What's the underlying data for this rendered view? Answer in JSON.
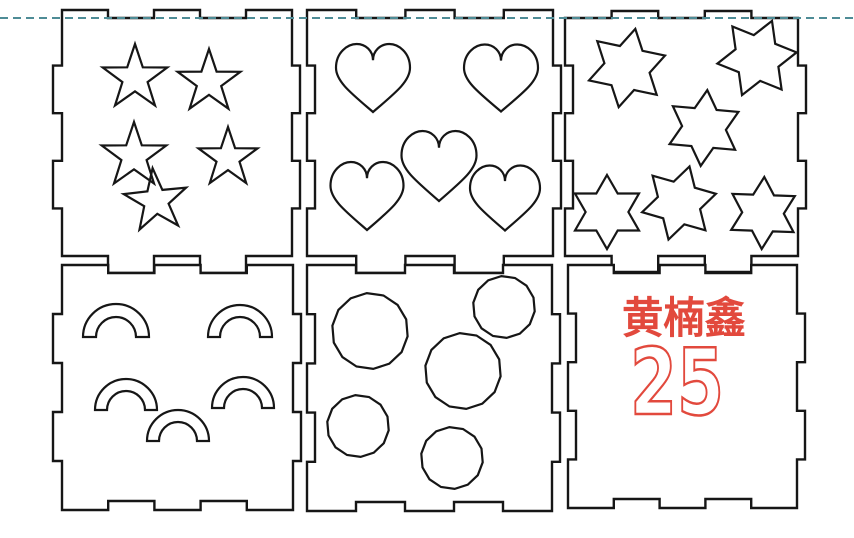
{
  "canvas": {
    "width": 854,
    "height": 538,
    "background": "#ffffff",
    "stroke_color": "#161616"
  },
  "guide_line": {
    "y": 18,
    "color": "#4e8c96",
    "dash": [
      8,
      5
    ],
    "thickness": 2
  },
  "engraving": {
    "color": "#e2493d"
  },
  "panels": [
    {
      "id": "plate-stars-5pt",
      "rect": {
        "x": 62,
        "y": 18,
        "w": 230,
        "h": 238
      },
      "edges": {
        "top": {
          "feature": "tabs_out",
          "segments": [
            1,
            3,
            5
          ],
          "depth": 8
        },
        "right": {
          "feature": "tabs_out",
          "segments": [
            2,
            4
          ],
          "depth": 8
        },
        "bottom": {
          "feature": "tabs_out",
          "segments": [
            2,
            4
          ],
          "depth": 17
        },
        "left": {
          "feature": "tabs_out",
          "segments": [
            2,
            4
          ],
          "depth": 9
        }
      },
      "shapes": {
        "type": "star5",
        "inner_ratio": 0.39,
        "items": [
          {
            "cx": 135,
            "cy": 78,
            "r": 34,
            "rot": 0
          },
          {
            "cx": 209,
            "cy": 82,
            "r": 33,
            "rot": 0
          },
          {
            "cx": 134,
            "cy": 156,
            "r": 34,
            "rot": 0
          },
          {
            "cx": 228,
            "cy": 158,
            "r": 31,
            "rot": 0
          },
          {
            "cx": 156,
            "cy": 201,
            "r": 33,
            "rot": -6
          }
        ]
      }
    },
    {
      "id": "plate-hearts",
      "rect": {
        "x": 307,
        "y": 18,
        "w": 246,
        "h": 238
      },
      "edges": {
        "top": {
          "feature": "tabs_out",
          "segments": [
            1,
            3,
            5
          ],
          "depth": 8
        },
        "right": {
          "feature": "tabs_out",
          "segments": [
            2,
            4
          ],
          "depth": 8
        },
        "bottom": {
          "feature": "tabs_out",
          "segments": [
            2,
            4
          ],
          "depth": 17
        },
        "left": {
          "feature": "notches_in",
          "segments": [
            2,
            4
          ],
          "depth": 8
        }
      },
      "shapes": {
        "type": "heart",
        "items": [
          {
            "cx": 373,
            "cy": 78,
            "w": 74,
            "h": 68
          },
          {
            "cx": 501,
            "cy": 78,
            "w": 74,
            "h": 67
          },
          {
            "cx": 439,
            "cy": 166,
            "w": 75,
            "h": 70
          },
          {
            "cx": 367,
            "cy": 196,
            "w": 73,
            "h": 68
          },
          {
            "cx": 505,
            "cy": 198,
            "w": 70,
            "h": 65
          }
        ]
      }
    },
    {
      "id": "plate-stars-6pt",
      "rect": {
        "x": 565,
        "y": 18,
        "w": 233,
        "h": 238
      },
      "edges": {
        "top": {
          "feature": "tabs_out",
          "segments": [
            2,
            4
          ],
          "depth": 7
        },
        "right": {
          "feature": "tabs_out",
          "segments": [
            2,
            4
          ],
          "depth": 8
        },
        "bottom": {
          "feature": "tabs_out",
          "segments": [
            2,
            4
          ],
          "depth": 16
        },
        "left": {
          "feature": "notches_in",
          "segments": [
            2,
            4
          ],
          "depth": 8
        }
      },
      "shapes": {
        "type": "star6",
        "inner_ratio": 0.578,
        "items": [
          {
            "cx": 627,
            "cy": 68,
            "r": 40,
            "rot": 12
          },
          {
            "cx": 757,
            "cy": 58,
            "r": 40,
            "rot": 22
          },
          {
            "cx": 704,
            "cy": 128,
            "r": 38,
            "rot": 5
          },
          {
            "cx": 607,
            "cy": 212,
            "r": 37,
            "rot": 0
          },
          {
            "cx": 679,
            "cy": 203,
            "r": 38,
            "rot": 16
          },
          {
            "cx": 763,
            "cy": 213,
            "r": 36,
            "rot": 2
          }
        ]
      }
    },
    {
      "id": "plate-arcs",
      "rect": {
        "x": 62,
        "y": 265,
        "w": 231,
        "h": 245
      },
      "edges": {
        "top": {
          "feature": "notches_in",
          "segments": [
            2,
            4
          ],
          "depth": 8
        },
        "right": {
          "feature": "tabs_out",
          "segments": [
            2,
            4
          ],
          "depth": 8
        },
        "bottom": {
          "feature": "notches_in",
          "segments": [
            2,
            4
          ],
          "depth": 9
        },
        "left": {
          "feature": "tabs_out",
          "segments": [
            2,
            4
          ],
          "depth": 9
        }
      },
      "shapes": {
        "type": "arc",
        "items": [
          {
            "cx": 116,
            "cy": 337,
            "ro": 33,
            "ri": 20
          },
          {
            "cx": 240,
            "cy": 337,
            "ro": 32,
            "ri": 20
          },
          {
            "cx": 126,
            "cy": 410,
            "ro": 31,
            "ri": 19
          },
          {
            "cx": 243,
            "cy": 408,
            "ro": 31,
            "ri": 19
          },
          {
            "cx": 178,
            "cy": 441,
            "ro": 31,
            "ri": 19
          }
        ]
      }
    },
    {
      "id": "plate-circles",
      "rect": {
        "x": 307,
        "y": 265,
        "w": 245,
        "h": 246
      },
      "edges": {
        "top": {
          "feature": "notches_in",
          "segments": [
            2,
            4
          ],
          "depth": 8
        },
        "right": {
          "feature": "tabs_out",
          "segments": [
            2,
            4
          ],
          "depth": 8
        },
        "bottom": {
          "feature": "notches_in",
          "segments": [
            2,
            4
          ],
          "depth": 9
        },
        "left": {
          "feature": "notches_in",
          "segments": [
            2,
            4
          ],
          "depth": 8
        }
      },
      "shapes": {
        "type": "circle",
        "items": [
          {
            "cx": 370,
            "cy": 331,
            "r": 38
          },
          {
            "cx": 504,
            "cy": 307,
            "r": 31
          },
          {
            "cx": 463,
            "cy": 371,
            "r": 38
          },
          {
            "cx": 358,
            "cy": 426,
            "r": 31
          },
          {
            "cx": 452,
            "cy": 458,
            "r": 31
          }
        ]
      }
    },
    {
      "id": "plate-name",
      "rect": {
        "x": 568,
        "y": 265,
        "w": 229,
        "h": 243
      },
      "edges": {
        "top": {
          "feature": "notches_in",
          "segments": [
            2,
            4
          ],
          "depth": 8
        },
        "right": {
          "feature": "tabs_out",
          "segments": [
            2,
            4
          ],
          "depth": 8
        },
        "bottom": {
          "feature": "notches_in",
          "segments": [
            2,
            4
          ],
          "depth": 9
        },
        "left": {
          "feature": "notches_in",
          "segments": [
            2,
            4
          ],
          "depth": 8
        }
      },
      "shapes": {
        "type": "none",
        "items": []
      },
      "text": {
        "name": "黄楠鑫",
        "number": "25",
        "color": "#e2493d"
      }
    }
  ]
}
